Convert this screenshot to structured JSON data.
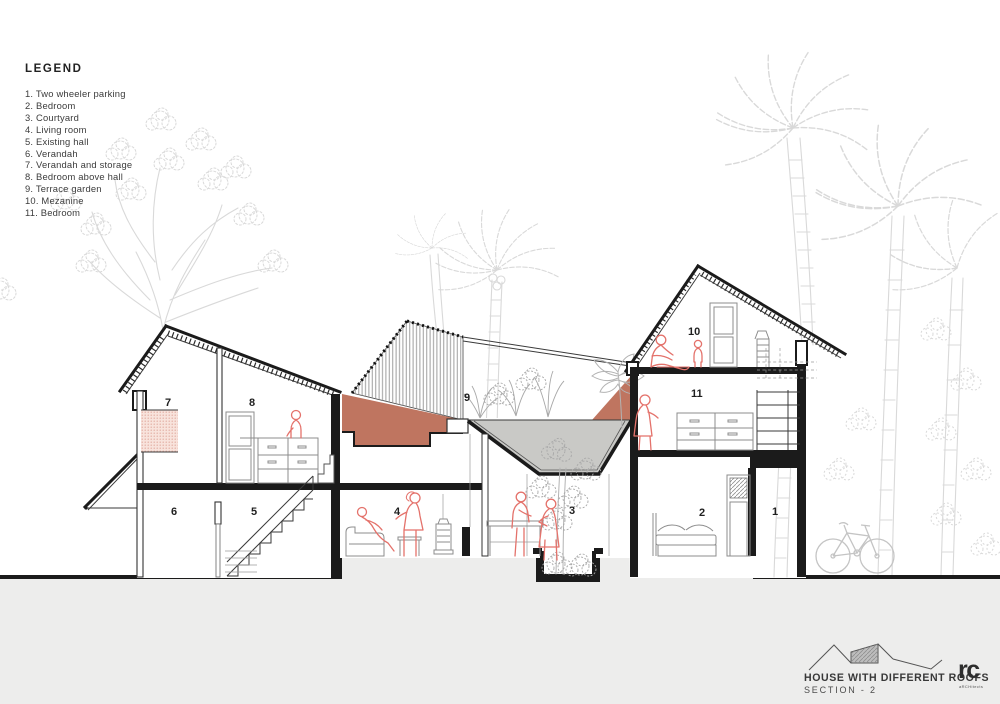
{
  "legend": {
    "title": "LEGEND",
    "items": [
      "1. Two wheeler parking",
      "2. Bedroom",
      "3. Courtyard",
      "4. Living room",
      "5. Existing hall",
      "6. Verandah",
      "7. Verandah and storage",
      "8. Bedroom above hall",
      "9. Terrace garden",
      "10. Mezanine",
      "11. Bedroom"
    ]
  },
  "title_block": {
    "project": "HOUSE WITH DIFFERENT ROOFS",
    "sheet": "SECTION - 2",
    "logo": "rc",
    "logo_sub": "aRCHitects"
  },
  "room_labels": {
    "r1": "1",
    "r2": "2",
    "r3": "3",
    "r4": "4",
    "r5": "5",
    "r6": "6",
    "r7": "7",
    "r8": "8",
    "r9": "9",
    "r10": "10",
    "r11": "11"
  },
  "colors": {
    "terracotta": "#bf7560",
    "funnel": "#c9c9c6",
    "ground": "#ededec",
    "pink": "#f8e3dc",
    "figred": "#e4726b",
    "tree": "#d9d9d9",
    "ink": "#1b1b1b"
  }
}
